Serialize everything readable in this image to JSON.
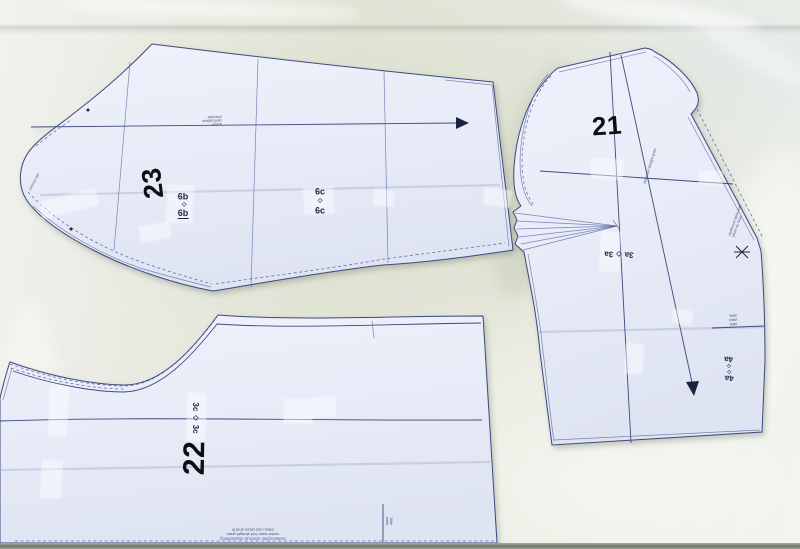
{
  "colors": {
    "paper": "#e8ecf8",
    "ink": "#3e4a7d",
    "fabric": "#e3e6d9",
    "number_ink": "#0e0e12"
  },
  "symbols": {
    "diamond": "◇"
  },
  "piece23": {
    "number": "23",
    "match_top_left": "6b",
    "match_bottom_left": "6b",
    "match_top_right": "6c",
    "match_bottom_right": "6c",
    "grain_text_l1": "fadenlauf",
    "grain_text_l2": "straight grain",
    "grain_text_l3": "droit fil",
    "tip_text": "umbruch fold"
  },
  "piece21": {
    "number": "21",
    "match_3a_left": "3a",
    "match_3a_right": "3a",
    "match_4a_top": "4a",
    "match_4a_bottom": "4a",
    "waist_l1": "Taille",
    "waist_l2": "waist",
    "waist_l3": "taille",
    "grain_text": "fadenlauf straight grain",
    "edge_text_l1": "stoffbruch fabric fold",
    "edge_text_l2": "pliure du tissu"
  },
  "piece22": {
    "number": "22",
    "match_3c_top": "3c",
    "match_3c_bottom": "3c",
    "waist_l1": "Taille",
    "waist_l2": "waist",
    "bottom_l1": "middenachter stofvouw draadrichting",
    "bottom_l2": "center back fold straight grain",
    "bottom_l3": "milieu dos pliure droit fil"
  }
}
